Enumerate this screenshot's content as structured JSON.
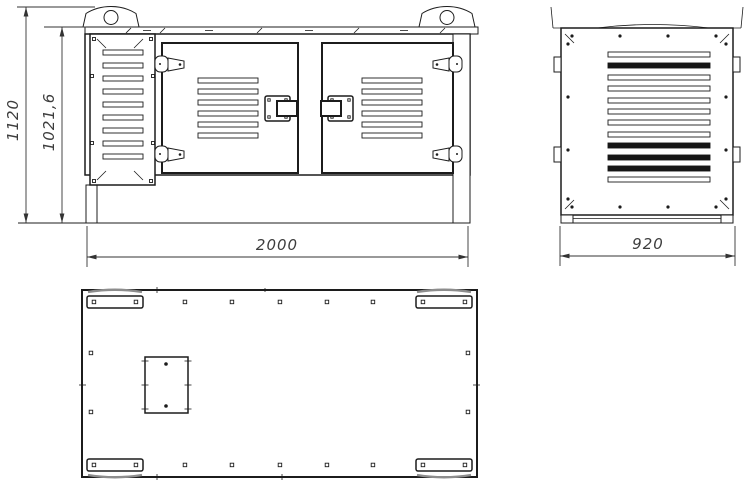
{
  "drawing": {
    "background": "#ffffff",
    "line_color": "#1c1c1c",
    "dim_color": "#3d3d3d"
  },
  "dimensions": {
    "front_total_height": "1120",
    "front_body_height": "1021,6",
    "front_width": "2000",
    "side_depth": "920"
  }
}
